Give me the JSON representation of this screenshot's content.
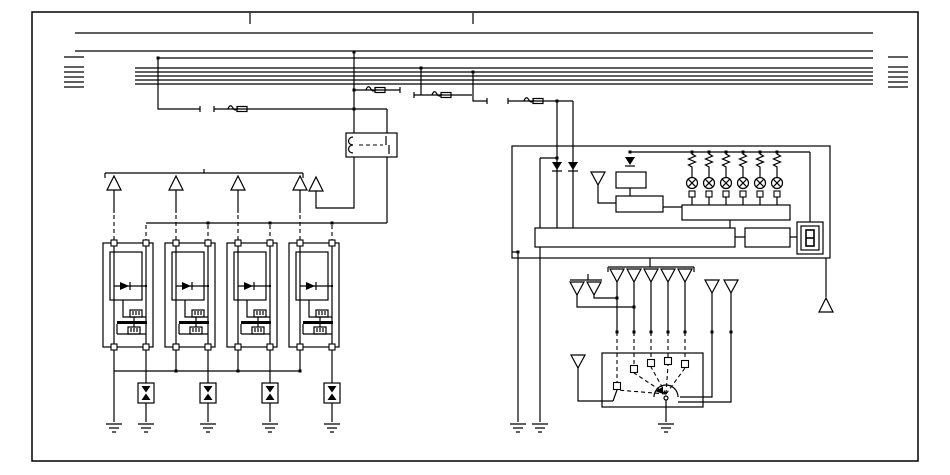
{
  "meta": {
    "description": "Ignition system wiring schematic (no text labels present)",
    "background_color": "#ffffff",
    "line_color": "#000000"
  },
  "bus": {
    "full_lines_y": [
      33,
      51
    ],
    "mid_line_y": 58,
    "group_lines_y": [
      68,
      72,
      76,
      80,
      84
    ],
    "full_x": [
      75,
      873
    ],
    "group_x": [
      135,
      873
    ],
    "stub_rows_y": [
      57,
      67,
      72,
      77,
      82,
      87
    ],
    "left_stub_x": [
      64,
      84
    ],
    "right_stub_x": [
      888,
      908
    ],
    "border_ticks_x": [
      250,
      473
    ]
  },
  "fuse_symbols": [
    [
      228,
      109
    ],
    [
      366,
      90
    ],
    [
      432,
      95
    ],
    [
      524,
      101
    ]
  ],
  "gap_ticks": [
    [
      200,
      109
    ],
    [
      214,
      109
    ],
    [
      400,
      90
    ],
    [
      414,
      95
    ],
    [
      487,
      101
    ],
    [
      508,
      101
    ]
  ],
  "junction_dots": [
    [
      158,
      58
    ],
    [
      354,
      52
    ],
    [
      354,
      90
    ],
    [
      354,
      109
    ],
    [
      421,
      68
    ],
    [
      473,
      72
    ],
    [
      557,
      101
    ],
    [
      557,
      158
    ],
    [
      518,
      252
    ],
    [
      208,
      223
    ],
    [
      270,
      223
    ],
    [
      332,
      223
    ],
    [
      176,
      371
    ],
    [
      238,
      371
    ],
    [
      300,
      371
    ],
    [
      617,
      298
    ],
    [
      634,
      307
    ],
    [
      617,
      332
    ],
    [
      634,
      332
    ],
    [
      651,
      332
    ],
    [
      668,
      332
    ],
    [
      685,
      332
    ],
    [
      712,
      332
    ],
    [
      731,
      332
    ]
  ],
  "relay": {
    "box": [
      346,
      133,
      51,
      24
    ]
  },
  "ignition_units": {
    "count": 4,
    "x": [
      103,
      165,
      227,
      289
    ],
    "y": 243,
    "width": 50,
    "height": 104
  },
  "coil_trigger_x": [
    114,
    176,
    238,
    300
  ],
  "coil_feed_drops_x": [
    146,
    208,
    270,
    332
  ],
  "spark_gaps_x": [
    146,
    208,
    270,
    332
  ],
  "grounds": {
    "x": [
      114,
      146,
      208,
      270,
      332,
      518,
      540,
      666
    ],
    "y": 424
  },
  "triangles_up": [
    [
      114,
      176
    ],
    [
      176,
      176
    ],
    [
      238,
      176
    ],
    [
      300,
      176
    ],
    [
      316,
      177
    ],
    [
      826,
      298
    ]
  ],
  "triangles_down": [
    [
      598,
      172
    ],
    [
      617,
      269
    ],
    [
      634,
      269
    ],
    [
      651,
      269
    ],
    [
      668,
      269
    ],
    [
      685,
      269
    ],
    [
      577,
      282
    ],
    [
      594,
      282
    ],
    [
      712,
      280
    ],
    [
      731,
      280
    ],
    [
      578,
      355
    ]
  ],
  "diodes_down": [
    [
      557,
      162
    ],
    [
      573,
      162
    ],
    [
      630,
      157
    ]
  ],
  "ecu": {
    "box": [
      512,
      146,
      318,
      112
    ],
    "main_board": [
      535,
      228,
      200,
      19
    ],
    "driver_box": [
      745,
      228,
      45,
      19
    ],
    "lamp_resistor_rail": {
      "y": 152,
      "x1": 630,
      "x2": 810
    },
    "rail_dots_x": [
      630,
      692,
      709,
      726,
      743,
      760,
      777
    ],
    "lamps_x": [
      692,
      709,
      726,
      743,
      760,
      777
    ],
    "lamp_module": [
      682,
      205,
      108,
      15
    ],
    "logic_box_small": [
      616,
      172,
      30,
      16
    ],
    "logic_box_large": [
      616,
      196,
      47,
      16
    ],
    "display_outer": [
      797,
      222,
      26,
      32
    ],
    "display_inner": [
      801,
      226,
      18,
      24
    ]
  },
  "distributor": {
    "box": [
      602,
      353,
      101,
      54
    ],
    "cap_terminal_squares": [
      [
        617,
        386
      ],
      [
        634,
        369
      ],
      [
        651,
        363
      ],
      [
        668,
        361
      ],
      [
        685,
        364
      ]
    ],
    "rotor_center": [
      666,
      394
    ]
  },
  "component_inventory": {
    "ignition_coil_units": 4,
    "spark_gaps": 4,
    "indicator_lamps": 6,
    "earth_grounds": 8,
    "fuses": 4,
    "relays": 1,
    "seven_segment_displays": 1,
    "connector_triangles": 17
  }
}
